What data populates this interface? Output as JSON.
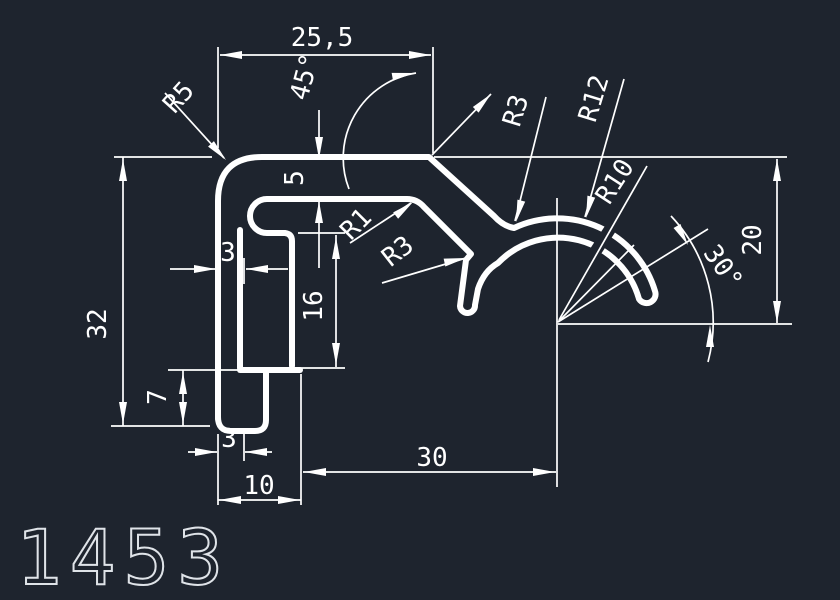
{
  "drawing": {
    "part_number": "1453",
    "dimensions": {
      "top_width": "25,5",
      "overall_height": "32",
      "top_wall": "3",
      "flange_thickness": "5",
      "web_height": "16",
      "foot_height": "7",
      "tip_width": "3",
      "foot_width": "10",
      "center_offset": "30",
      "right_height": "20"
    },
    "angles": {
      "slope": "45°",
      "claw": "30°"
    },
    "radii": {
      "corner": "R5",
      "fillet_small": "R1",
      "notch": "R3",
      "hook_fillet": "R3",
      "hook_outer": "R12",
      "hook_inner": "R10"
    },
    "colors": {
      "background": "#1e242e",
      "line": "#ffffff"
    }
  }
}
